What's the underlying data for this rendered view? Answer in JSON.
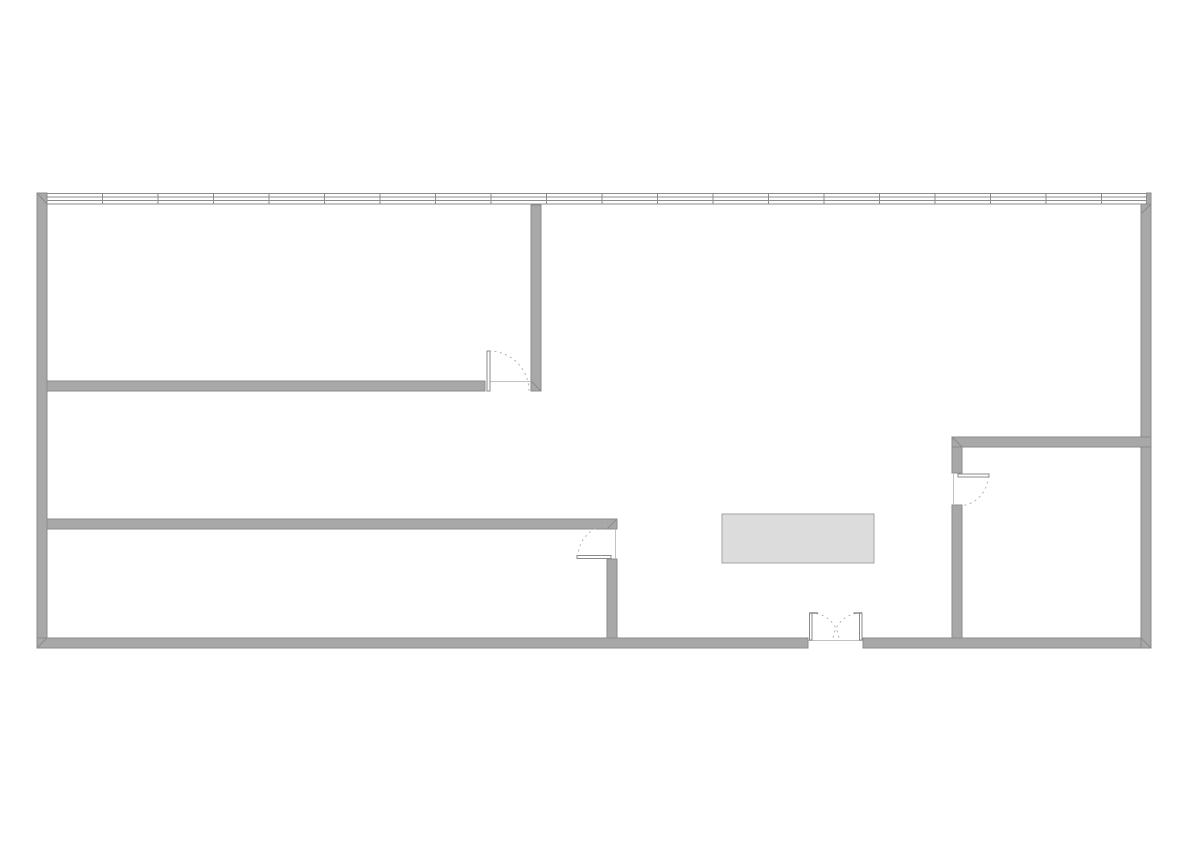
{
  "plan": {
    "canvas": {
      "width": 1191,
      "height": 842,
      "background": "#ffffff"
    },
    "colors": {
      "wall_fill": "#a8a8a8",
      "wall_edge": "#8b8b8b",
      "window_line": "#8b8b8b",
      "swing_arc": "#b3b3b3",
      "leaf_fill": "#ffffff",
      "leaf_stroke": "#8b8b8b",
      "thin_line": "#c2c2c2",
      "furniture_fill": "#dcdcdc",
      "furniture_edge": "#a3a3a3"
    },
    "walls": [
      {
        "name": "exterior-wall-left",
        "x": 37,
        "y": 193,
        "w": 10,
        "h": 455
      },
      {
        "name": "exterior-wall-bottom-west",
        "x": 37,
        "y": 638,
        "w": 771,
        "h": 10
      },
      {
        "name": "exterior-wall-bottom-east",
        "x": 863,
        "y": 638,
        "w": 288,
        "h": 10
      },
      {
        "name": "exterior-wall-right",
        "x": 1141,
        "y": 204,
        "w": 10,
        "h": 444
      },
      {
        "name": "window-wall-right-cap",
        "x": 1146.5,
        "y": 193,
        "w": 4.5,
        "h": 11
      },
      {
        "name": "room1-south-wall",
        "x": 47,
        "y": 381,
        "w": 438,
        "h": 10
      },
      {
        "name": "room1-east-wall",
        "x": 531,
        "y": 205,
        "w": 10,
        "h": 186
      },
      {
        "name": "corridor-south-wall",
        "x": 47,
        "y": 519,
        "w": 570,
        "h": 10
      },
      {
        "name": "room2-east-wall",
        "x": 607,
        "y": 559,
        "w": 10,
        "h": 79
      },
      {
        "name": "room3-north-wall",
        "x": 952,
        "y": 437,
        "w": 199,
        "h": 10
      },
      {
        "name": "room3-west-wall-upper",
        "x": 952,
        "y": 447,
        "w": 10,
        "h": 26
      },
      {
        "name": "room3-west-wall-lower",
        "x": 952,
        "y": 505,
        "w": 10,
        "h": 133
      }
    ],
    "miters": [
      {
        "name": "miter-top-left",
        "x1": 37,
        "y1": 193,
        "x2": 47,
        "y2": 204
      },
      {
        "name": "miter-bottom-left",
        "x1": 37,
        "y1": 648,
        "x2": 47,
        "y2": 638
      },
      {
        "name": "miter-bottom-right",
        "x1": 1151,
        "y1": 648,
        "x2": 1141,
        "y2": 638
      },
      {
        "name": "miter-top-right",
        "x1": 1141,
        "y1": 214,
        "x2": 1151,
        "y2": 204
      },
      {
        "name": "miter-room3-corner",
        "x1": 952,
        "y1": 437,
        "x2": 962,
        "y2": 447
      },
      {
        "name": "miter-corridor-end",
        "x1": 607,
        "y1": 529,
        "x2": 617,
        "y2": 519
      },
      {
        "name": "miter-room1-corner",
        "x1": 531,
        "y1": 381,
        "x2": 541,
        "y2": 391
      }
    ],
    "window_wall": {
      "name": "window-wall-north",
      "x1": 47,
      "x2": 1148,
      "line_ys": [
        193.5,
        197,
        200.5,
        204
      ],
      "mullion_start": 102.5,
      "mullion_spacing": 55.5,
      "mullion_max": 1140,
      "mullion_y1": 193.5,
      "mullion_y2": 204,
      "cap_x": 1148
    },
    "doors": [
      {
        "name": "door-room1",
        "leaves": [
          {
            "x": 487,
            "y": 351,
            "w": 3,
            "h": 40
          }
        ],
        "ticks": [],
        "arcs": [
          "M 489 351 A 40 40 0 0 1 529 391"
        ],
        "lines": [
          {
            "x1": 490,
            "y1": 381.5,
            "x2": 531,
            "y2": 381.5
          }
        ]
      },
      {
        "name": "door-room2",
        "leaves": [
          {
            "x": 577,
            "y": 555.5,
            "w": 34,
            "h": 3
          }
        ],
        "ticks": [],
        "arcs": [
          "M 578 557 A 32 32 0 0 1 610 525"
        ],
        "lines": [
          {
            "x1": 615.5,
            "y1": 529,
            "x2": 615.5,
            "y2": 559
          }
        ]
      },
      {
        "name": "door-room3",
        "leaves": [
          {
            "x": 958,
            "y": 474,
            "w": 31,
            "h": 3
          }
        ],
        "ticks": [],
        "arcs": [
          "M 988 476 A 30 30 0 0 1 958 506"
        ],
        "lines": [
          {
            "x1": 953.5,
            "y1": 473,
            "x2": 953.5,
            "y2": 505
          }
        ]
      },
      {
        "name": "entrance-double-door",
        "leaves": [
          {
            "x": 809.5,
            "y": 613,
            "w": 2.5,
            "h": 27
          },
          {
            "x": 859.5,
            "y": 613,
            "w": 2.5,
            "h": 27
          }
        ],
        "ticks": [
          {
            "x1": 809.5,
            "y1": 613,
            "x2": 818,
            "y2": 613
          },
          {
            "x1": 853.5,
            "y1": 613,
            "x2": 862,
            "y2": 613
          }
        ],
        "arcs": [
          "M 811 613 A 28 28 0 0 1 839 641",
          "M 861 613 A 28 28 0 0 0 833 641"
        ],
        "lines": [
          {
            "x1": 808,
            "y1": 640.5,
            "x2": 863,
            "y2": 640.5
          },
          {
            "x1": 808,
            "y1": 638,
            "x2": 808,
            "y2": 648,
            "edge": true
          },
          {
            "x1": 863,
            "y1": 638,
            "x2": 863,
            "y2": 648,
            "edge": true
          }
        ]
      }
    ],
    "furniture": [
      {
        "name": "table",
        "x": 722,
        "y": 514,
        "w": 152,
        "h": 49
      }
    ]
  }
}
